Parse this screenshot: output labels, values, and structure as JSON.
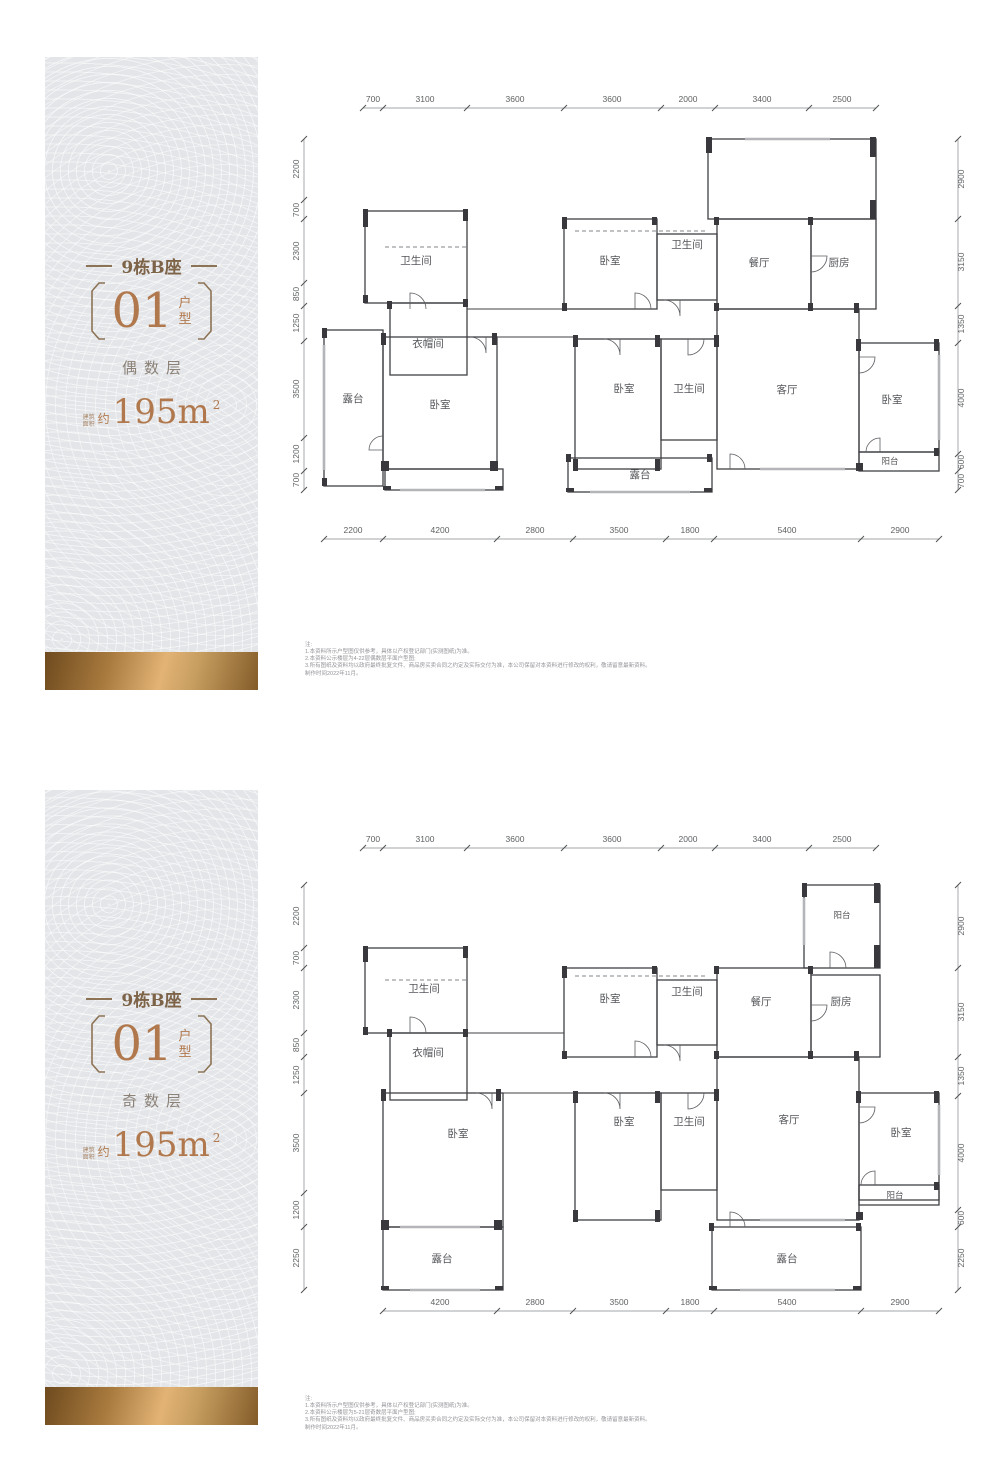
{
  "panels": [
    {
      "building": "9栋B座",
      "unit_number": "01",
      "unit_label_top": "户",
      "unit_label_bottom": "型",
      "floor_label": "偶数层",
      "area_prefix_line1": "建筑",
      "area_prefix_line2": "面积",
      "area_approx": "约",
      "area_value": "195m",
      "area_unit_sup": "2"
    },
    {
      "building": "9栋B座",
      "unit_number": "01",
      "unit_label_top": "户",
      "unit_label_bottom": "型",
      "floor_label": "奇数层",
      "area_prefix_line1": "建筑",
      "area_prefix_line2": "面积",
      "area_approx": "约",
      "area_value": "195m",
      "area_unit_sup": "2"
    }
  ],
  "colors": {
    "accent_copper": "#b0784c",
    "bronze_dark": "#7d6347",
    "panel_bg": "#e3e5e8",
    "gold_band": "#c79e60",
    "wall": "#404145",
    "dim_text": "#5f6163"
  },
  "plans": [
    {
      "dims_top": [
        "700",
        "3100",
        "3600",
        "3600",
        "2000",
        "3400",
        "2500"
      ],
      "dims_bottom": [
        "2200",
        "4200",
        "2800",
        "3500",
        "1800",
        "5400",
        "2900"
      ],
      "dims_left": [
        "2200",
        "700",
        "2300",
        "850",
        "1250",
        "3500",
        "1200",
        "700"
      ],
      "dims_right": [
        "2900",
        "3150",
        "1350",
        "4000",
        "600",
        "700"
      ],
      "rooms": {
        "bath_top_left": "卫生间",
        "cloakroom": "衣帽间",
        "terrace_left": "露台",
        "bed_left": "卧室",
        "bed_top_mid": "卧室",
        "bath_top_mid": "卫生间",
        "dining": "餐厅",
        "kitchen": "厨房",
        "bed_mid": "卧室",
        "bath_mid": "卫生间",
        "living": "客厅",
        "bed_right": "卧室",
        "balcony_right": "阳台",
        "terrace_bottom": "露台"
      },
      "notes": [
        "注:",
        "1.本资料所示户型图仅供参考，具体以产权登记部门(实测图纸)为准。",
        "2.本资料公示楼层为4-22层偶数层平面户型图;",
        "3.所有图纸及资料均以政府最终批复文件、商品房买卖合同之约定及实际交付为准，本公司保留对本资料进行修改的权利，敬请留意最新资料。",
        "制作时间2022年11月。"
      ]
    },
    {
      "dims_top": [
        "700",
        "3100",
        "3600",
        "3600",
        "2000",
        "3400",
        "2500"
      ],
      "dims_bottom": [
        "4200",
        "2800",
        "3500",
        "1800",
        "5400",
        "2900"
      ],
      "dims_left": [
        "2200",
        "700",
        "2300",
        "850",
        "1250",
        "3500",
        "1200",
        "2250"
      ],
      "dims_right": [
        "2900",
        "3150",
        "1350",
        "4000",
        "600",
        "2250"
      ],
      "rooms": {
        "balcony_top": "阳台",
        "bath_top_left": "卫生间",
        "cloakroom": "衣帽间",
        "bed_left": "卧室",
        "terrace_bottom_left": "露台",
        "bed_top_mid": "卧室",
        "bath_top_mid": "卫生间",
        "dining": "餐厅",
        "kitchen": "厨房",
        "bed_mid": "卧室",
        "bath_mid": "卫生间",
        "living": "客厅",
        "bed_right": "卧室",
        "balcony_right": "阳台",
        "terrace_bottom": "露台"
      },
      "notes": [
        "注:",
        "1.本资料所示户型图仅供参考，具体以产权登记部门(实测图纸)为准。",
        "2.本资料公示楼层为5-21层奇数层平面户型图;",
        "3.所有图纸及资料均以政府最终批复文件、商品房买卖合同之约定及实际交付为准，本公司保留对本资料进行修改的权利，敬请留意最新资料。",
        "制作时间2022年11月。"
      ]
    }
  ]
}
